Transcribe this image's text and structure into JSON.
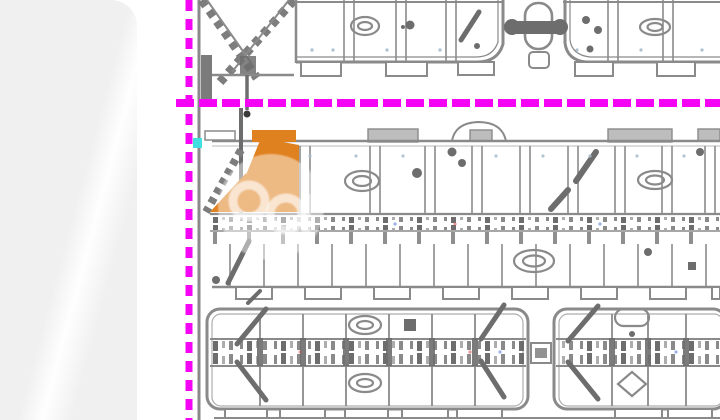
{
  "image": {
    "type": "subdivision-site-plan",
    "alt": "Residential subdivision plat map with highlighted lot",
    "description": "Gray CAD site plan of townhouse rows; magenta dashed plat boundary lines run along the left edge and horizontally across the plan; one lot group near the boundary corner is highlighted in orange; a translucent circular watermark logo overlays the highlighted lot; a small cyan marker sits beside the vertical boundary; the left side of the frame is a blank light-gray photo margin."
  },
  "colors": {
    "page_bg": "#ffffff",
    "panel_gray": "#f0f0f1",
    "boundary_magenta": "#f503f5",
    "parcel_orange": "#e0811f",
    "linework_gray": "#8a8a8a",
    "linework_dark": "#6d6d6d",
    "linework_light": "#bdbdbd",
    "marker_cyan": "#3fdfe2",
    "fleck_blue": "#5a7ddb",
    "fleck_red": "#d05050",
    "watermark_white": "#ffffff"
  },
  "elements": {
    "left_panel": "blank photo margin",
    "boundary_vertical": "vertical dashed plat boundary",
    "boundary_horizontal": "horizontal dashed plat boundary",
    "hatch_crossing": "diagonal hatched embankment crossing",
    "top_row": "upper townhouse row (cut at top)",
    "middle_rows": "back-to-back townhouse rows",
    "bottom_blocks": "two lower townhouse blocks (cut at bottom)",
    "highlighted_parcel": "orange highlighted lot",
    "highlighted_parcel_secondary": "orange highlighted corner sliver",
    "watermark": "translucent watermark logo",
    "cyan_marker": "cyan reference marker"
  }
}
